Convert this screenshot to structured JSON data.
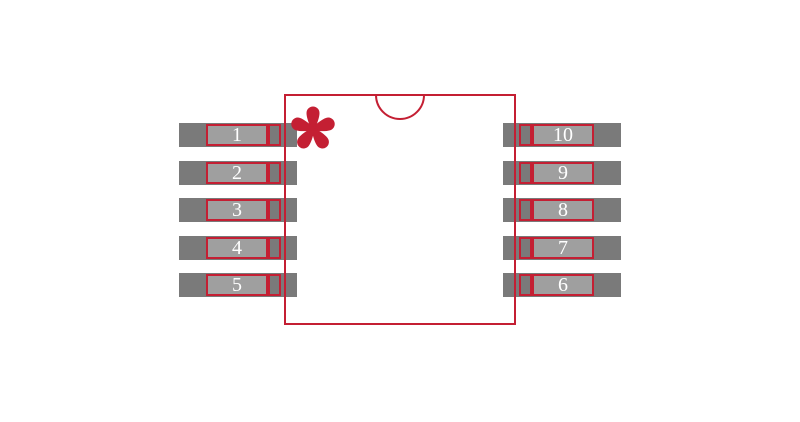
{
  "figure": {
    "kind": "ic-package-footprint-diagram",
    "pin_count_label": "10"
  },
  "colors": {
    "background": "#ffffff",
    "outline_red": "#c41f33",
    "pad_dark": "#7a7a7a",
    "pin_text": "#ffffff"
  },
  "pins": {
    "left": [
      "1",
      "2",
      "3",
      "4",
      "5"
    ],
    "right": [
      "10",
      "9",
      "8",
      "7",
      "6"
    ]
  },
  "markers": {
    "pin1_marker": "asterisk-icon",
    "orientation_notch": "top-center-semicircle"
  }
}
